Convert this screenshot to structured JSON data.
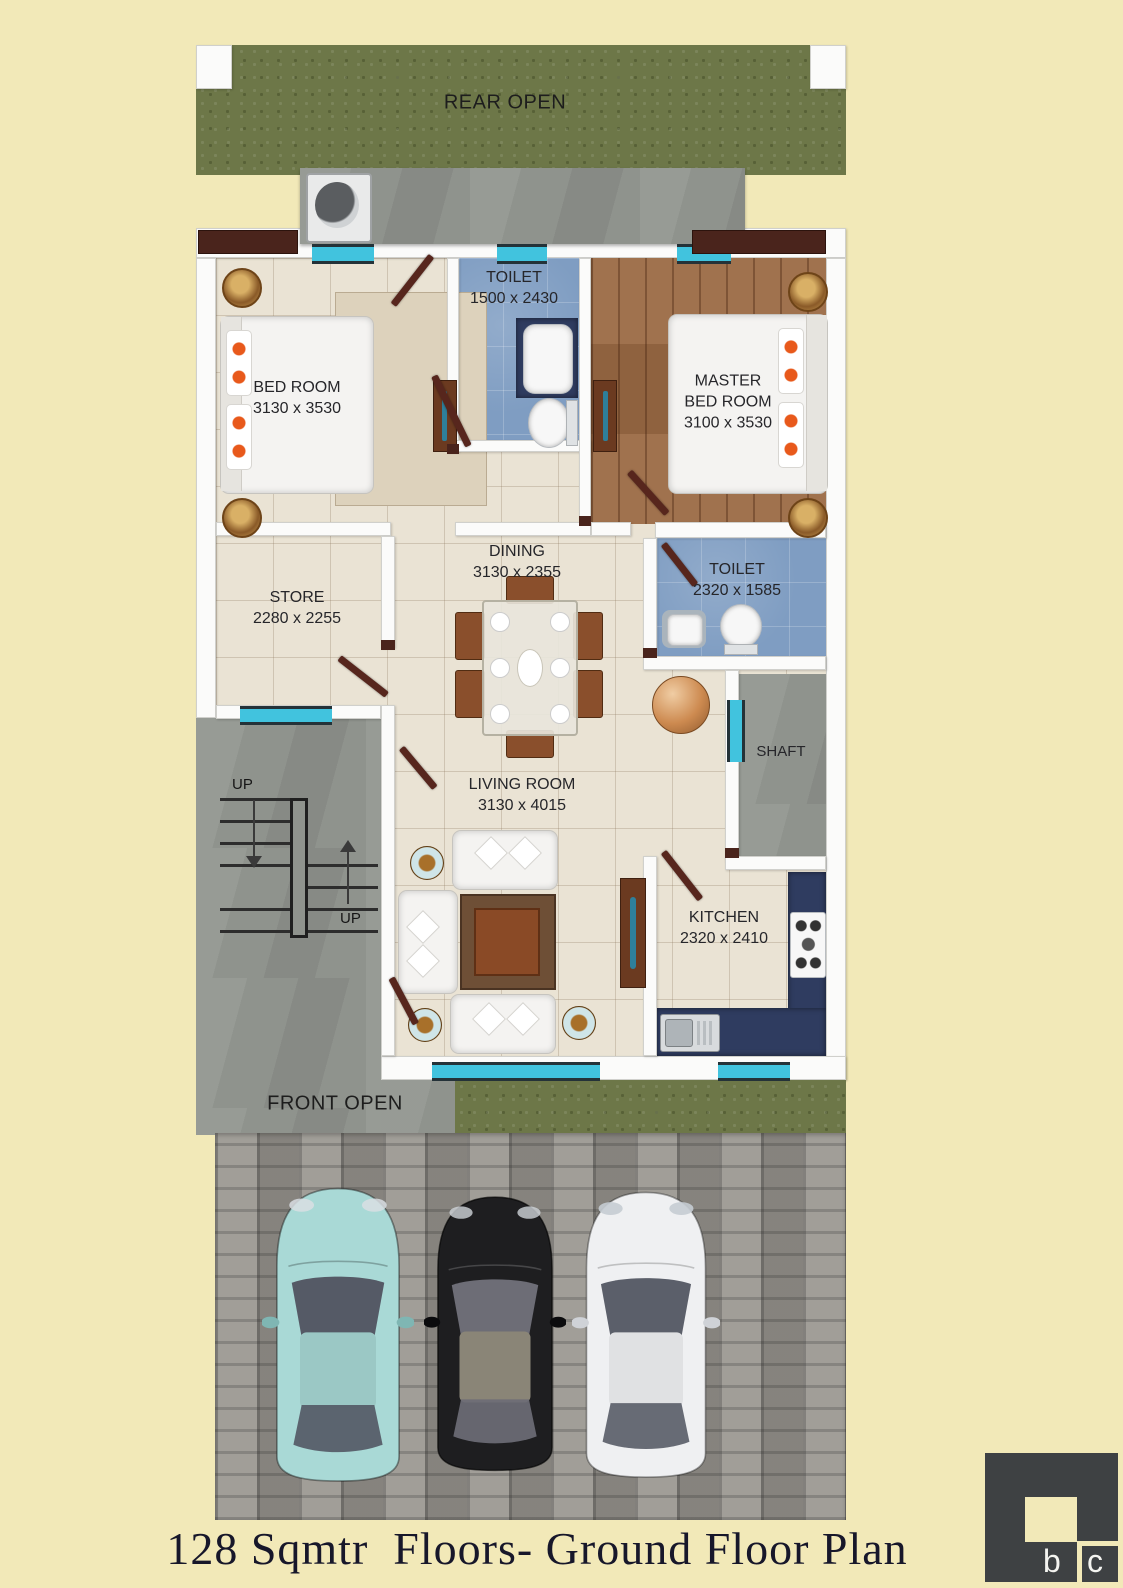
{
  "title": "128 Sqmtr  Floors- Ground Floor Plan",
  "outdoor": {
    "rear": "REAR OPEN",
    "front": "FRONT OPEN"
  },
  "stairs": {
    "up_lower": "UP",
    "up_upper": "UP"
  },
  "rooms": {
    "bedroom": {
      "name": "BED ROOM",
      "dims": "3130 x 3530"
    },
    "toilet_top": {
      "name": "TOILET",
      "dims": "1500 x 2430"
    },
    "master": {
      "line1": "MASTER",
      "line2": "BED ROOM",
      "dims": "3100 x 3530"
    },
    "dining": {
      "name": "DINING",
      "dims": "3130 x 2355"
    },
    "store": {
      "name": "STORE",
      "dims": "2280 x 2255"
    },
    "toilet_mid": {
      "name": "TOILET",
      "dims": "2320 x 1585"
    },
    "living": {
      "name": "LIVING ROOM",
      "dims": "3130 x 4015"
    },
    "kitchen": {
      "name": "KITCHEN",
      "dims": "2320 x 2410"
    },
    "shaft": {
      "name": "SHAFT"
    }
  },
  "cars": [
    {
      "name": "teal-car",
      "body": "#a9d9d6",
      "shade": "#7fb6b3",
      "glass": "#555a66"
    },
    {
      "name": "black-car",
      "body": "#1e1e20",
      "shade": "#0b0b0d",
      "glass": "#6d6d76"
    },
    {
      "name": "white-car",
      "body": "#eff0f2",
      "shade": "#cfd2d7",
      "glass": "#5b5f6a"
    }
  ],
  "logo": {
    "b": "b",
    "c": "c"
  },
  "colors": {
    "background": "#f2e9b8",
    "grass": "#6d7748",
    "concrete": "#8f938d",
    "floor_tile": "#eae3d4",
    "wood_floor": "#9b6a44",
    "toilet_blue": "#7f9dc2",
    "counter_navy": "#2f3c60",
    "window_cyan": "#41c3de",
    "door_brown": "#57261d",
    "wall_white": "#fbfbfa",
    "logo_gray": "#3e4143"
  }
}
